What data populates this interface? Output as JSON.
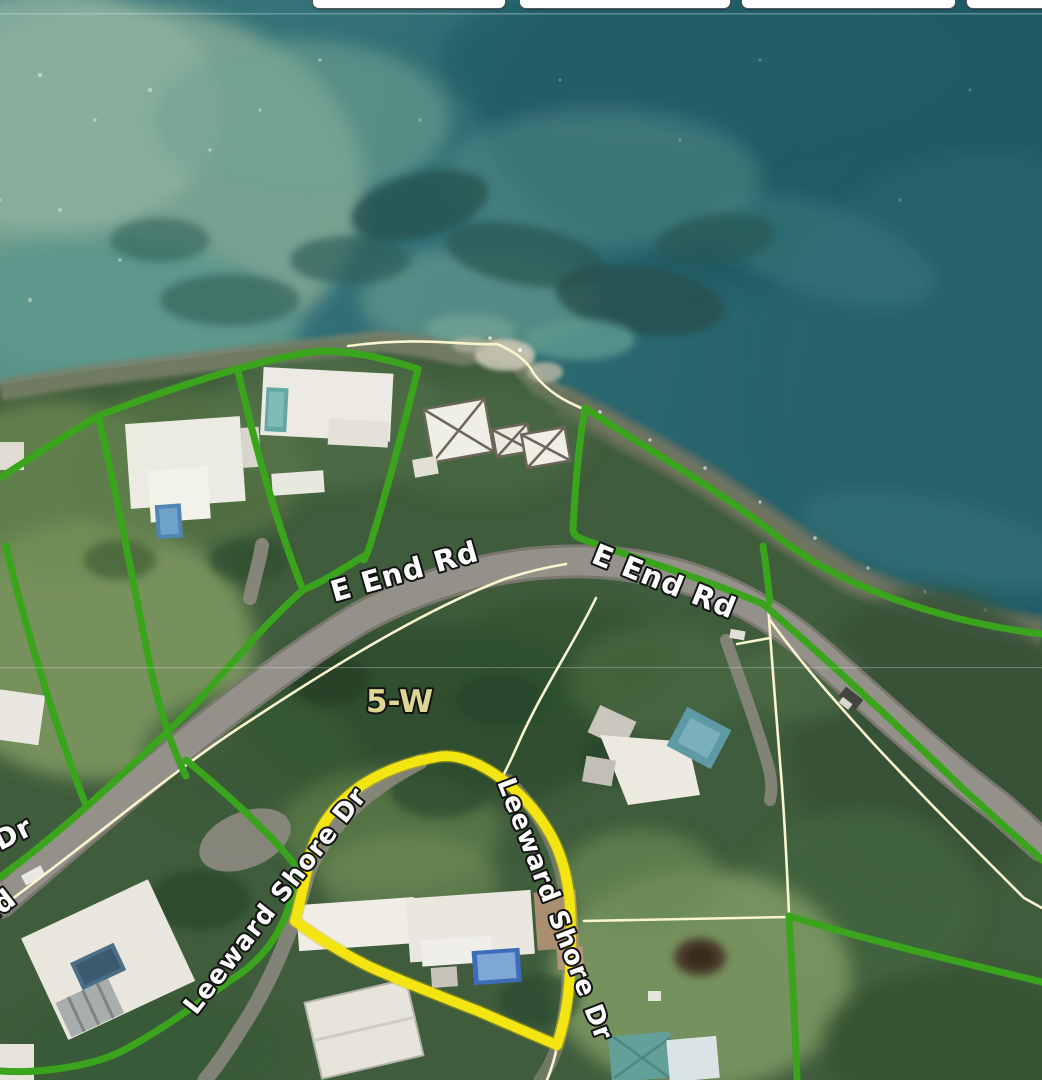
{
  "app": {
    "name": "parcel-map-viewer"
  },
  "toolbar": {
    "buttons": [
      {
        "label": ""
      },
      {
        "label": ""
      },
      {
        "label": ""
      },
      {
        "label": ""
      }
    ]
  },
  "map": {
    "road_labels": [
      {
        "text": "E End Rd"
      },
      {
        "text": "E End Rd"
      }
    ],
    "street_labels": [
      {
        "text": "Leeward Shore Dr"
      },
      {
        "text": "Leeward Shore Dr"
      }
    ],
    "parcel_label": {
      "text": "5-W"
    },
    "edge_labels": [
      {
        "text": "Dr"
      },
      {
        "text": "Rd"
      }
    ],
    "colors": {
      "highlight_parcel": "#f2e512",
      "parcel_boundary_green": "#3aa41d",
      "parcel_line_thin": "#f8f4cf",
      "road_surface": "#94918a",
      "ocean_base": "#33717a",
      "ocean_deep": "#255f68",
      "ocean_shallow": "#7fa694",
      "vegetation": "#3f5c3c",
      "road_label_fill": "#ffffff",
      "parcel_label_fill": "#ddd795"
    }
  }
}
